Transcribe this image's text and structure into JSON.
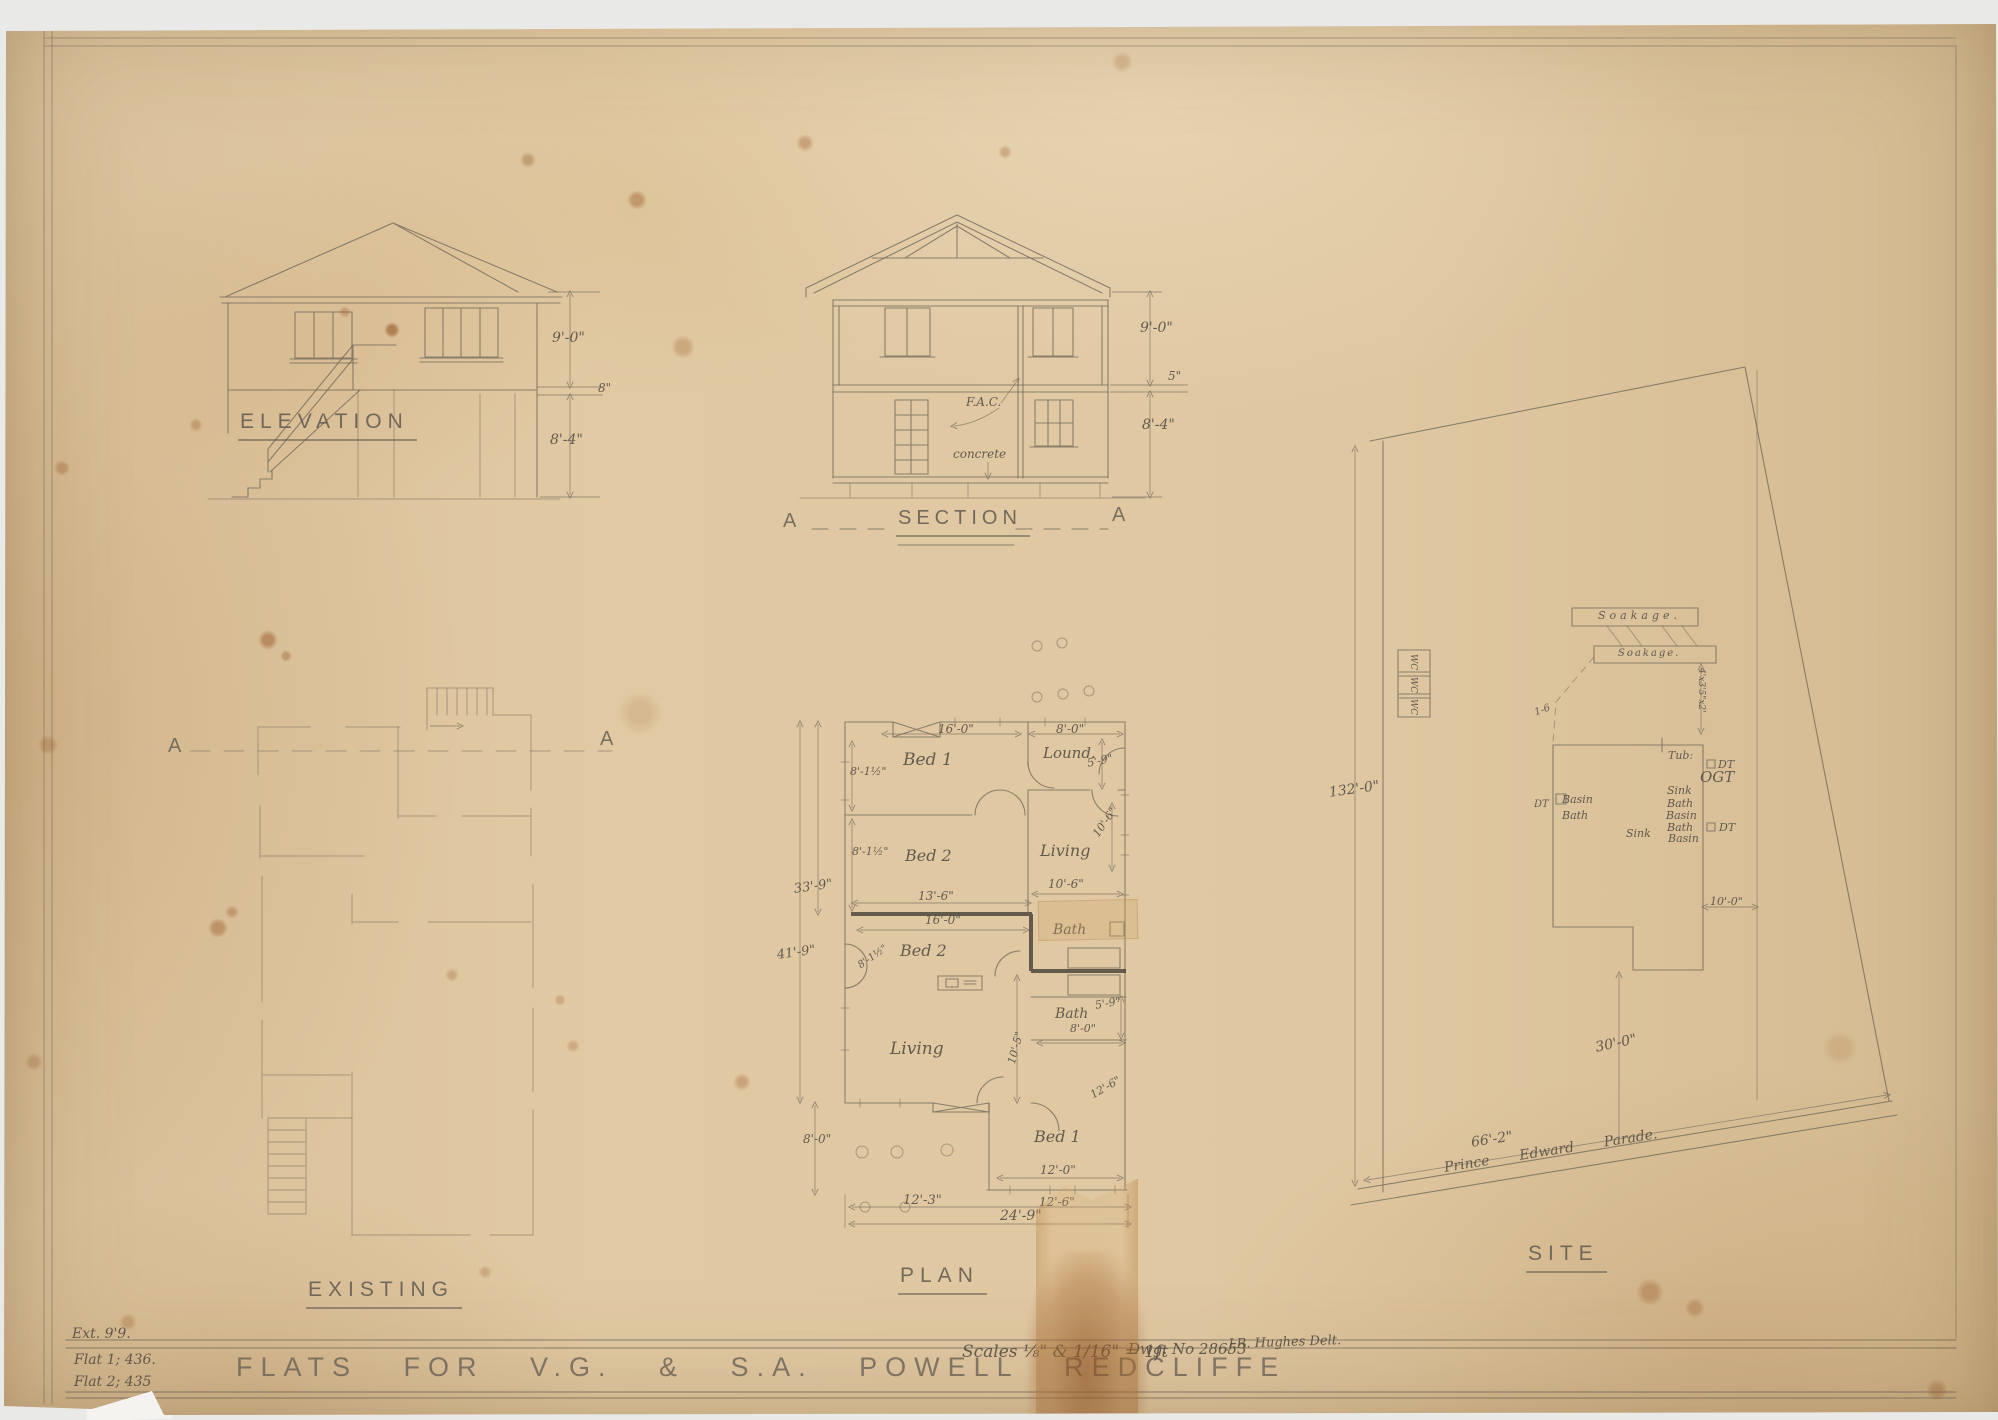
{
  "sheet": {
    "title": "FLATS FOR V.G. & S.A. POWELL REDCLIFFE",
    "scales": "Scales ⅛\" & 1/16\" = 1ft",
    "drawing_no": "Dwg. No 28653",
    "draughtsman": "J.R. Hughes Delt.",
    "margin_notes": [
      "Ext. 9'9.",
      "Flat 1; 436.",
      "Flat 2; 435"
    ]
  },
  "elevation": {
    "title": "ELEVATION",
    "dims": {
      "upper": "9'-0\"",
      "band": "8\"",
      "lower": "8'-4\""
    }
  },
  "section": {
    "title": "SECTION",
    "marker": "A",
    "fac": "F.A.C.",
    "concrete": "concrete",
    "dims": {
      "upper": "9'-0\"",
      "band": "5\"",
      "lower": "8'-4\""
    }
  },
  "existing": {
    "title": "EXISTING",
    "marker": "A"
  },
  "plan": {
    "title": "PLAN",
    "rooms": {
      "bed1_top": "Bed 1",
      "lounge": "Lound.",
      "bed2_top": "Bed 2",
      "living_top": "Living",
      "bed2_mid": "Bed 2",
      "bath_top": "Bath",
      "bath_mid": "Bath",
      "living_bot": "Living",
      "bed1_bot": "Bed 1"
    },
    "dims": {
      "w16a": "16'-0\"",
      "w8": "8'-0\"",
      "h59": "5'-9\"",
      "h81a": "8'-1½\"",
      "h81b": "8'-1½\"",
      "h81c": "8'-1½\"",
      "v106a": "10'-6\"",
      "h106b": "10'-6\"",
      "h136": "13'-6\"",
      "w16b": "16'-0\"",
      "b59": "5'-9\"",
      "b80": "8'-0\"",
      "v105": "10'-5\"",
      "s126": "12'-6\"",
      "l80": "8'-0\"",
      "w120": "12'-0\"",
      "w123": "12'-3\"",
      "w126": "12'-6\"",
      "w249": "24'-9\"",
      "v339": "33'-9\"",
      "v419": "41'-9\""
    }
  },
  "site": {
    "title": "SITE",
    "road": "Prince Edward Parade.",
    "soakage1": "Soakage.",
    "soakage2": "Soakage.",
    "wc": "WC",
    "dims": {
      "depth": "132'-0\"",
      "frontage": "66'-2\"",
      "setback": "30'-0\"",
      "side": "10'-0\"",
      "gap": "1-6",
      "tank": "4'x3'5\"x2'"
    },
    "fixtures": {
      "tub": "Tub:",
      "dt1": "DT",
      "ogt": "OGT",
      "dt2": "DT",
      "dt3": "DT",
      "sink1": "Sink",
      "bath1": "Bath",
      "basin1": "Basin",
      "bath2": "Bath",
      "basin2": "Basin",
      "sink2": "Sink",
      "bath3": "Bath",
      "basin3": "Basin"
    }
  }
}
